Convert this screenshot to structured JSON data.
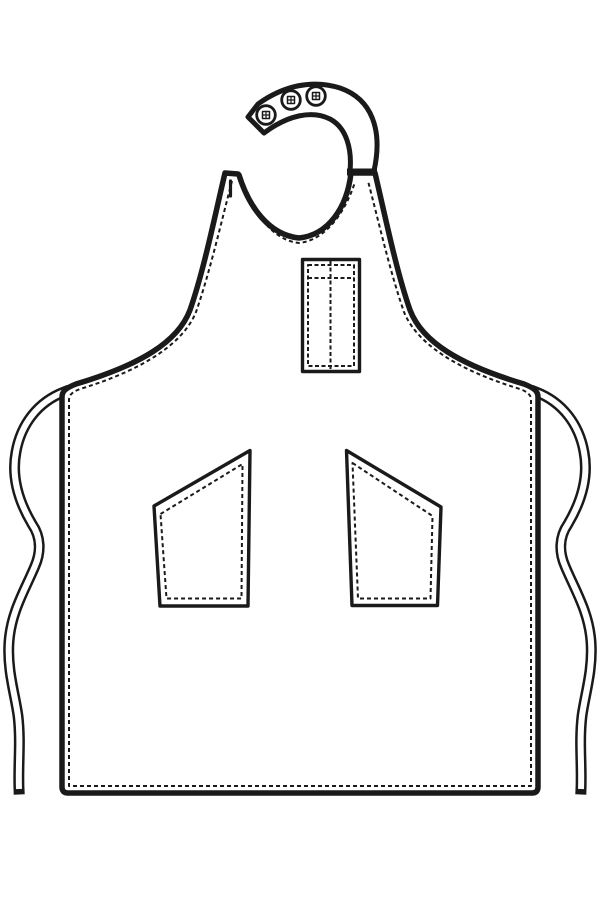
{
  "illustration": {
    "title": "Apron technical flat drawing",
    "style": "black line art on white",
    "parts": {
      "neck_strap": "curved adjustable neck strap",
      "snap_buttons": {
        "count": 3,
        "glyph": "circle with small cross-hatched square"
      },
      "left_shoulder_buttonhole": "vertical slot on left shoulder tab",
      "chest_pocket": "rectangular chest pocket with center divider stitch and top hem stitch",
      "left_hip_pocket": "slanted-entry hip pocket",
      "right_hip_pocket": "slanted-entry hip pocket (mirrored)",
      "waist_ties": "two long wavy waist ties with cut ends",
      "topstitching": "dashed stitch lines inset along all edges and hem"
    }
  },
  "colors": {
    "line": "#1a1a1a",
    "background": "#ffffff",
    "fill": "#ffffff"
  }
}
